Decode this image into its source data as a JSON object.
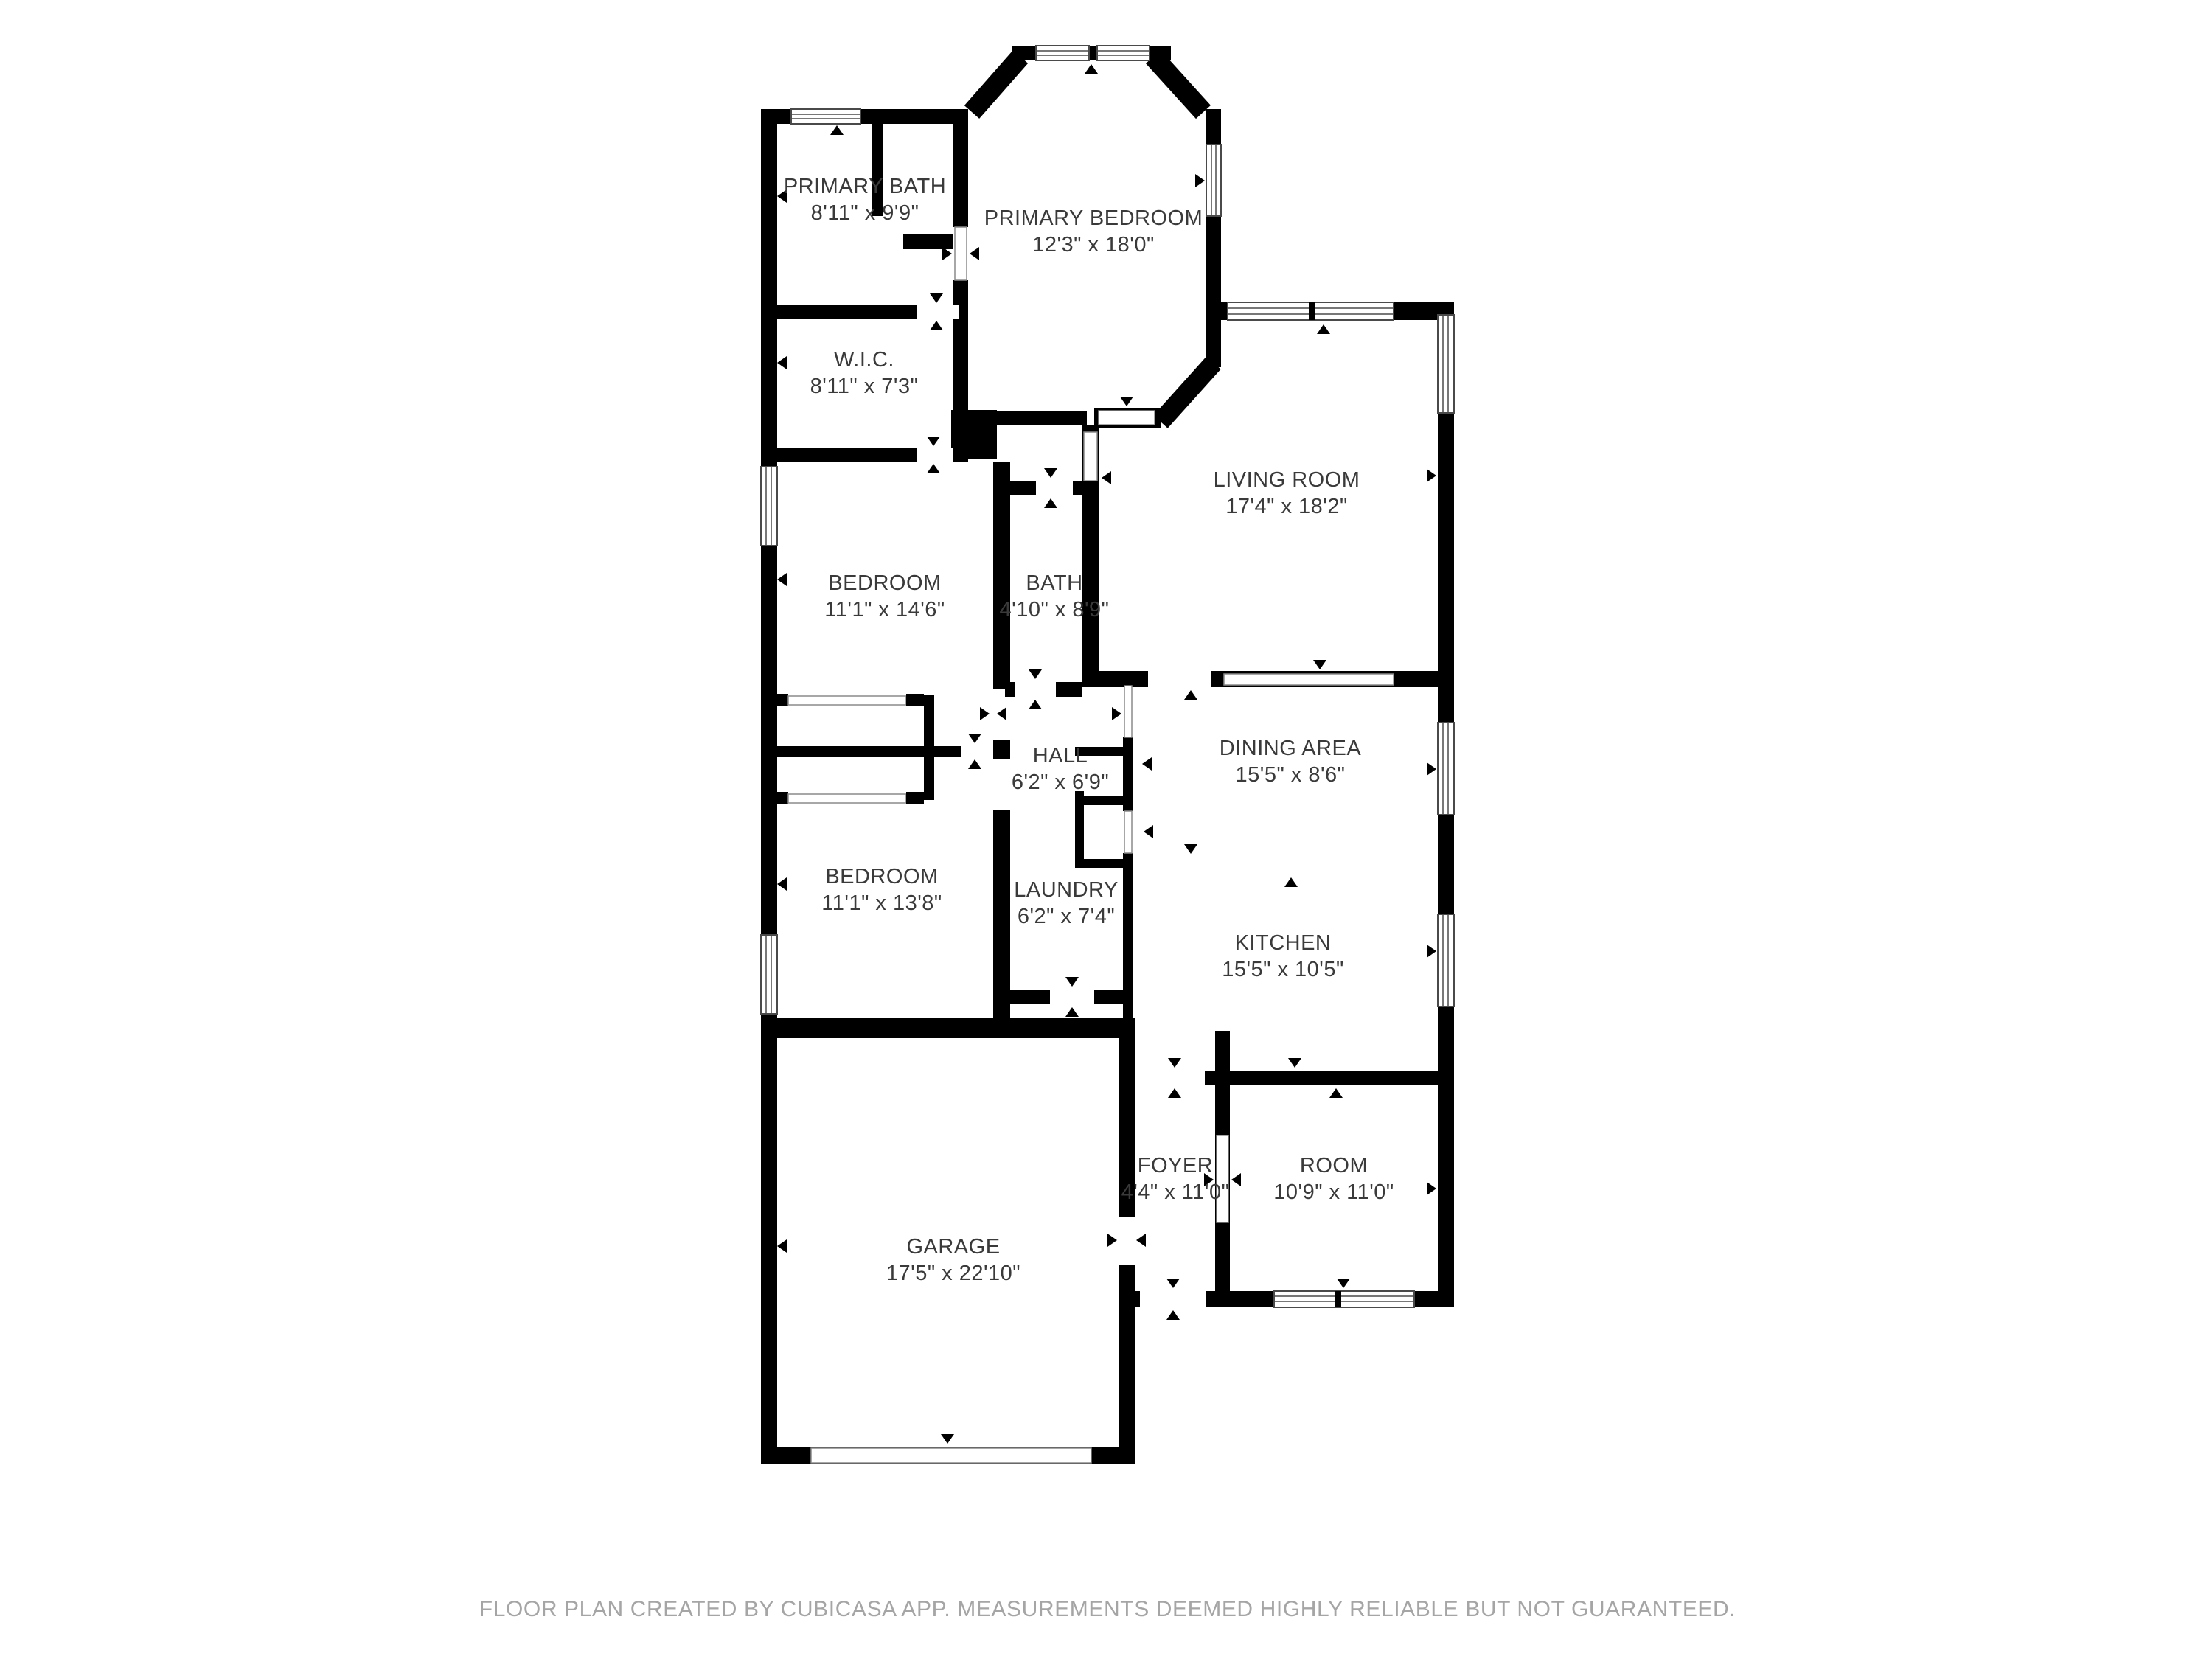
{
  "floorplan": {
    "rooms": [
      {
        "name": "PRIMARY BATH",
        "dims": "8'11\" x 9'9\""
      },
      {
        "name": "PRIMARY BEDROOM",
        "dims": "12'3\" x 18'0\""
      },
      {
        "name": "W.I.C.",
        "dims": "8'11\" x 7'3\""
      },
      {
        "name": "LIVING ROOM",
        "dims": "17'4\" x 18'2\""
      },
      {
        "name": "BEDROOM",
        "dims": "11'1\" x 14'6\""
      },
      {
        "name": "BATH",
        "dims": "4'10\" x 8'9\""
      },
      {
        "name": "HALL",
        "dims": "6'2\" x 6'9\""
      },
      {
        "name": "DINING AREA",
        "dims": "15'5\" x 8'6\""
      },
      {
        "name": "BEDROOM",
        "dims": "11'1\" x 13'8\""
      },
      {
        "name": "LAUNDRY",
        "dims": "6'2\" x 7'4\""
      },
      {
        "name": "KITCHEN",
        "dims": "15'5\" x 10'5\""
      },
      {
        "name": "GARAGE",
        "dims": "17'5\" x 22'10\""
      },
      {
        "name": "FOYER",
        "dims": "4'4\" x 11'0\""
      },
      {
        "name": "ROOM",
        "dims": "10'9\" x 11'0\""
      }
    ],
    "footer": "FLOOR PLAN CREATED BY CUBICASA APP. MEASUREMENTS DEEMED HIGHLY RELIABLE BUT NOT GUARANTEED.",
    "colors": {
      "wall": "#000000",
      "floor": "#ffffff",
      "label": "#3a3a3a",
      "footer": "#a5a5a5"
    }
  }
}
